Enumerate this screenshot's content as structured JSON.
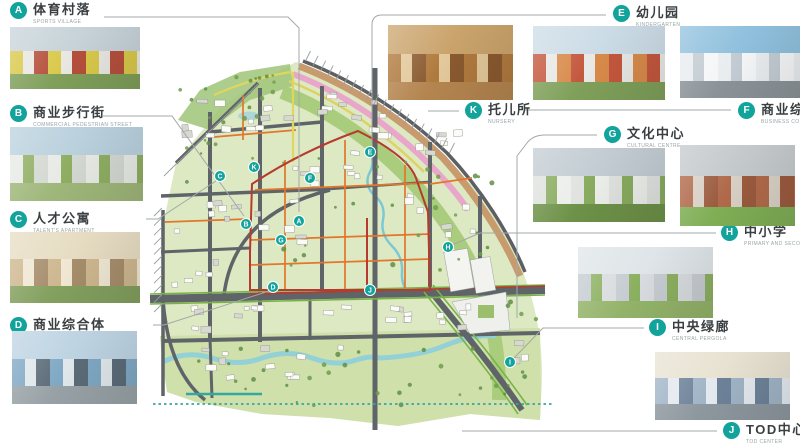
{
  "colors": {
    "accent": "#11a39c",
    "red": "#b73a2e",
    "orange": "#e2762a",
    "teal": "#35a79f",
    "leader": "#a2a8aa"
  },
  "callouts": [
    {
      "letter": "A",
      "title": "体育村落",
      "caption": "SPORTS VILLAGE",
      "photo": {
        "sky": "#c7d3d9",
        "b1": "#d9c94a",
        "b2": "#e9e7e2",
        "b3": "#b54f3c",
        "ground": "#7f9f5a"
      }
    },
    {
      "letter": "B",
      "title": "商业步行街",
      "caption": "COMMERCIAL PEDESTRIAN STREET",
      "photo": {
        "sky": "#b9d0dd",
        "b1": "#e8eae6",
        "b2": "#8fae62",
        "b3": "#d4d8d2",
        "ground": "#9fb77a"
      }
    },
    {
      "letter": "C",
      "title": "人才公寓",
      "caption": "TALENT'S APARTMENT",
      "photo": {
        "sky": "#e6dcc2",
        "b1": "#cdb78f",
        "b2": "#efe7d2",
        "b3": "#a68d6b",
        "ground": "#83a05e"
      }
    },
    {
      "letter": "D",
      "title": "商业综合体",
      "caption": "BUSINESS COMPLEX",
      "photo": {
        "sky": "#bdd3e2",
        "b1": "#7fa8c4",
        "b2": "#dfe7ea",
        "b3": "#5b6b78",
        "ground": "#98a2a6"
      }
    },
    {
      "letter": "E",
      "title": "幼儿园",
      "caption": "KINDERGARTEN",
      "photo": {
        "sky": "#ccdce6",
        "b1": "#c4573d",
        "b2": "#e8e8e6",
        "b3": "#d88a4a",
        "ground": "#7fa05a"
      }
    },
    {
      "letter": "K",
      "title": "托儿所",
      "caption": "NURSERY",
      "photo": {
        "sky": "#caa36b",
        "b1": "#b07a3e",
        "b2": "#e2c89a",
        "b3": "#8a5a30",
        "ground": "#b4854f"
      }
    },
    {
      "letter": "F",
      "title": "商业综合体",
      "caption": "BUSINESS COMPLEX",
      "photo": {
        "sky": "#8fc0dd",
        "b1": "#e9edf0",
        "b2": "#c2ccd2",
        "b3": "#f4f6f7",
        "ground": "#8b9398"
      }
    },
    {
      "letter": "G",
      "title": "文化中心",
      "caption": "CULTURAL CENTRE",
      "photo": {
        "sky": "#c2ccd2",
        "b1": "#dfe2df",
        "b2": "#88ab5e",
        "b3": "#eceeea",
        "ground": "#6d9148"
      }
    },
    {
      "letter": "H",
      "title": "中小学",
      "caption": "PRIMARY AND SECONDARY SCHOOL",
      "photo": {
        "sky": "#c3c8cb",
        "b1": "#b0694a",
        "b2": "#d8cfc4",
        "b3": "#9a5a3e",
        "ground": "#7fae55"
      }
    },
    {
      "letter": "I",
      "title": "中央绿廊",
      "caption": "CENTRAL PERGOLA",
      "photo": {
        "sky": "#dfe5e8",
        "b1": "#c6ccd1",
        "b2": "#8cb061",
        "b3": "#d8dcdf",
        "ground": "#93b369"
      }
    },
    {
      "letter": "J",
      "title": "TOD中心",
      "caption": "TOD CENTER",
      "photo": {
        "sky": "#e8e2d2",
        "b1": "#9fb4c6",
        "b2": "#e3e9ee",
        "b3": "#6d8299",
        "ground": "#8d979e"
      }
    }
  ],
  "map": {
    "markers": [
      {
        "letter": "A",
        "x": 299,
        "y": 221
      },
      {
        "letter": "B",
        "x": 246,
        "y": 224
      },
      {
        "letter": "C",
        "x": 220,
        "y": 176
      },
      {
        "letter": "D",
        "x": 273,
        "y": 287
      },
      {
        "letter": "E",
        "x": 370,
        "y": 152
      },
      {
        "letter": "F",
        "x": 310,
        "y": 178
      },
      {
        "letter": "G",
        "x": 281,
        "y": 240
      },
      {
        "letter": "H",
        "x": 448,
        "y": 247
      },
      {
        "letter": "I",
        "x": 510,
        "y": 362
      },
      {
        "letter": "J",
        "x": 370,
        "y": 290
      },
      {
        "letter": "K",
        "x": 254,
        "y": 167
      }
    ]
  }
}
